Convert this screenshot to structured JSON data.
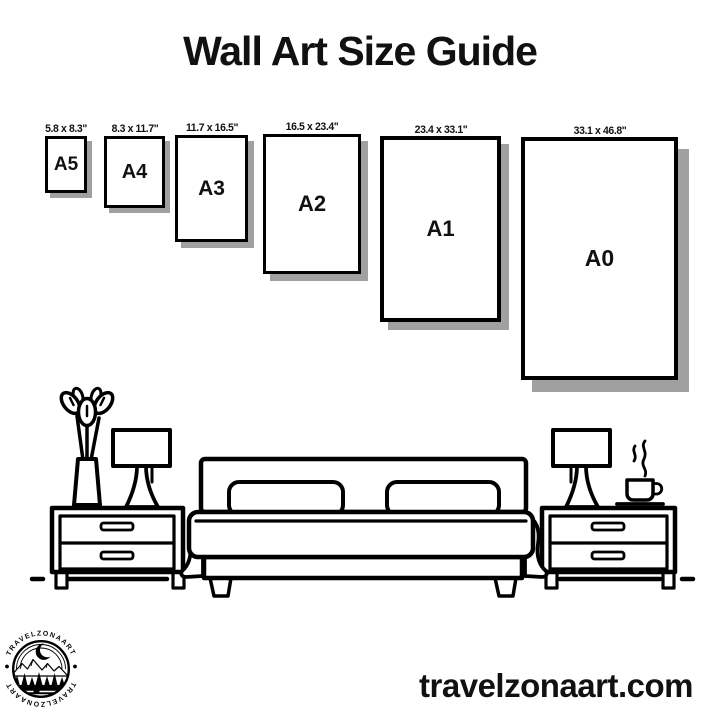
{
  "title": "Wall Art Size Guide",
  "papers": [
    {
      "name": "A5",
      "dims": "5.8 x 8.3\""
    },
    {
      "name": "A4",
      "dims": "8.3 x 11.7\""
    },
    {
      "name": "A3",
      "dims": "11.7 x 16.5\""
    },
    {
      "name": "A2",
      "dims": "16.5 x 23.4\""
    },
    {
      "name": "A1",
      "dims": "23.4 x 33.1\""
    },
    {
      "name": "A0",
      "dims": "33.1 x 46.8\""
    }
  ],
  "logo": {
    "text_top": "TRAVELZONAART",
    "text_bottom": "TRAVELZONAART"
  },
  "footer": {
    "website": "travelzonaart.com"
  },
  "colors": {
    "ink": "#000000",
    "background": "#ffffff",
    "paper_shadow": "#a0a0a0"
  }
}
